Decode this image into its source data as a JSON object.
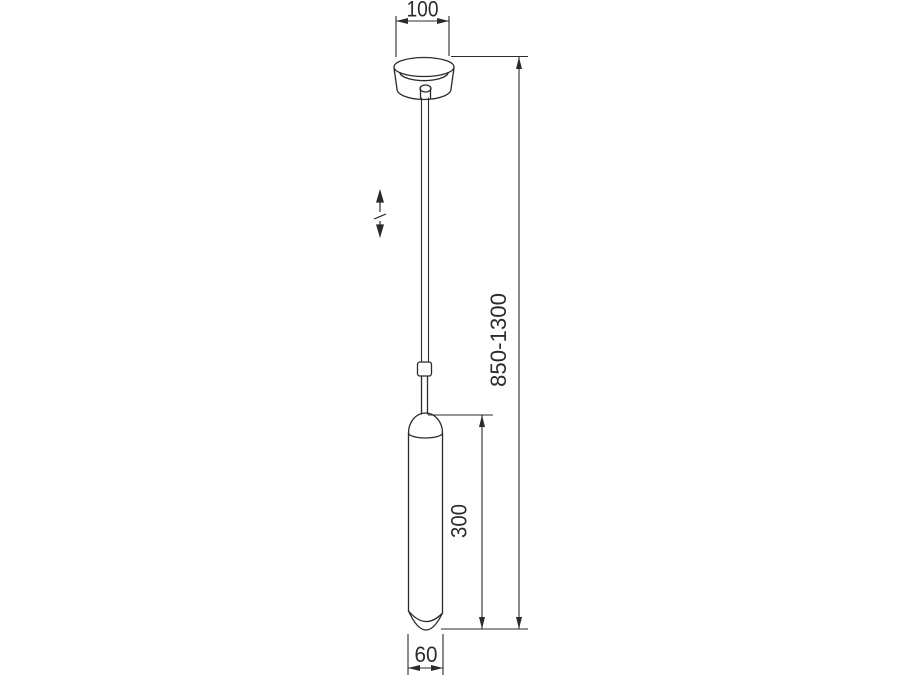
{
  "page": {
    "background_color": "#ffffff"
  },
  "drawing": {
    "kind": "technical-dimension-drawing",
    "subject": "pendant-ceiling-light",
    "line_color": "#2b2b2b",
    "labels": {
      "canopy_diameter": "100",
      "suspension_height_range": "850-1300",
      "lamp_body_height": "300",
      "lamp_body_diameter": "60"
    }
  }
}
